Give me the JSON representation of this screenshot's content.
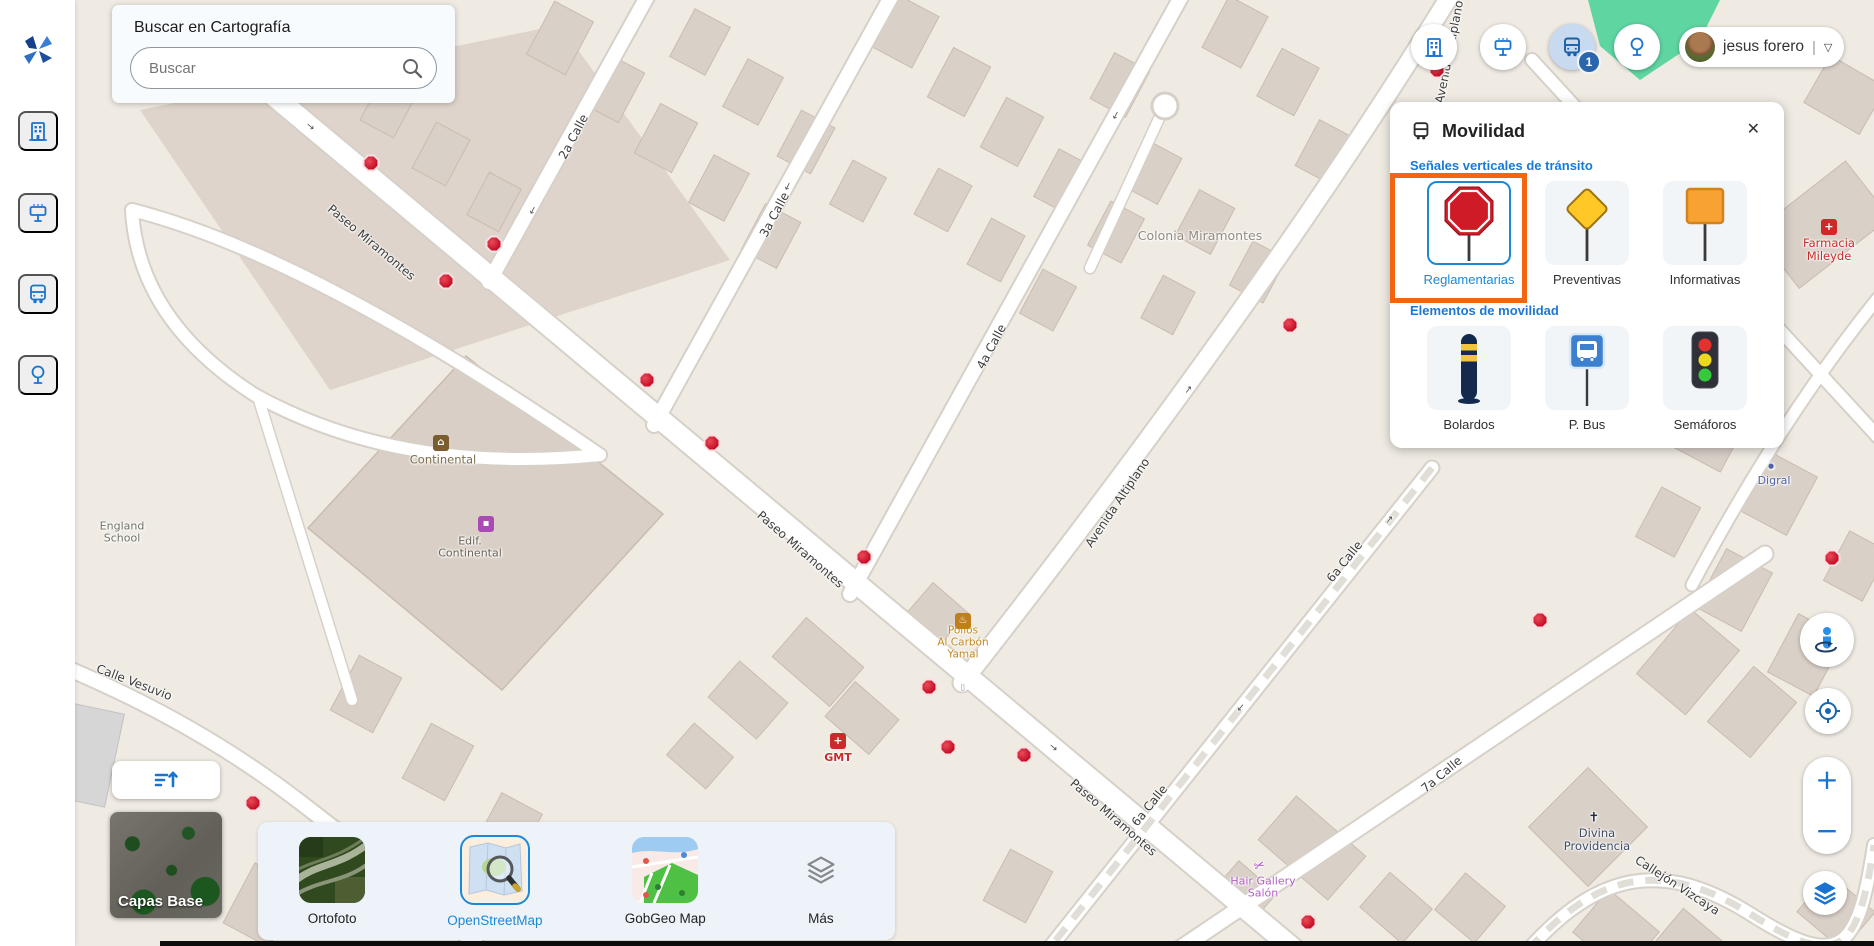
{
  "colors": {
    "accent": "#1a73d0",
    "selected_blue": "#1e88d2",
    "highlight_orange": "#f4650f",
    "marker_red": "#c30e26"
  },
  "search": {
    "title": "Buscar en Cartografía",
    "placeholder": "Buscar"
  },
  "sidebar": {
    "icons": [
      "app-logo",
      "buildings",
      "billboard",
      "bus",
      "tree"
    ]
  },
  "topbar": {
    "buttons": [
      "buildings",
      "billboard",
      "bus",
      "tree"
    ],
    "active_button": "bus",
    "badge": "1",
    "user": {
      "name": "jesus forero",
      "separator": "|",
      "caret": "▽"
    }
  },
  "movilidad": {
    "title": "Movilidad",
    "close": "✕",
    "sections": [
      {
        "title": "Señales verticales de tránsito",
        "items": [
          {
            "label": "Reglamentarias",
            "icon": "stop-sign",
            "selected": true,
            "highlighted": true
          },
          {
            "label": "Preventivas",
            "icon": "warning-diamond",
            "selected": false
          },
          {
            "label": "Informativas",
            "icon": "info-square",
            "selected": false
          }
        ]
      },
      {
        "title": "Elementos de movilidad",
        "items": [
          {
            "label": "Bolardos",
            "icon": "bollard",
            "selected": false
          },
          {
            "label": "P. Bus",
            "icon": "bus-stop-sign",
            "selected": false
          },
          {
            "label": "Semáforos",
            "icon": "traffic-light",
            "selected": false
          }
        ]
      }
    ]
  },
  "base": {
    "widget_label": "Capas Base",
    "options": [
      {
        "label": "Ortofoto",
        "selected": false
      },
      {
        "label": "OpenStreetMap",
        "selected": true
      },
      {
        "label": "GobGeo Map",
        "selected": false
      },
      {
        "label": "Más",
        "icon": "layers",
        "selected": false
      }
    ]
  },
  "controls": {
    "zoom_in": "+",
    "zoom_out": "−",
    "items": [
      "street-view",
      "locate",
      "zoom-in",
      "zoom-out",
      "layers"
    ]
  },
  "map": {
    "markers": [
      {
        "x": 371,
        "y": 163
      },
      {
        "x": 494,
        "y": 244
      },
      {
        "x": 446,
        "y": 281
      },
      {
        "x": 647,
        "y": 380
      },
      {
        "x": 712,
        "y": 443
      },
      {
        "x": 864,
        "y": 557
      },
      {
        "x": 929,
        "y": 687
      },
      {
        "x": 948,
        "y": 747
      },
      {
        "x": 1024,
        "y": 755
      },
      {
        "x": 1290,
        "y": 325
      },
      {
        "x": 1540,
        "y": 620
      },
      {
        "x": 1832,
        "y": 558
      },
      {
        "x": 253,
        "y": 803
      },
      {
        "x": 1308,
        "y": 922
      },
      {
        "x": 1437,
        "y": 70
      }
    ],
    "labels": [
      {
        "text": "2a Calle",
        "x": 574,
        "y": 137,
        "rot": -62
      },
      {
        "text": "3a Calle",
        "x": 775,
        "y": 215,
        "rot": -62
      },
      {
        "text": "4a Calle",
        "x": 992,
        "y": 347,
        "rot": -62
      },
      {
        "text": "6a Calle",
        "x": 1345,
        "y": 562,
        "rot": -51
      },
      {
        "text": "6a Calle",
        "x": 1150,
        "y": 806,
        "rot": -51
      },
      {
        "text": "7a Calle",
        "x": 1442,
        "y": 775,
        "rot": -40
      },
      {
        "text": "Paseo Miramontes",
        "x": 371,
        "y": 243,
        "rot": 40
      },
      {
        "text": "Paseo Miramontes",
        "x": 800,
        "y": 550,
        "rot": 41
      },
      {
        "text": "Paseo Miramontes",
        "x": 1113,
        "y": 818,
        "rot": 41
      },
      {
        "text": "Avenida Altiplano",
        "x": 1118,
        "y": 503,
        "rot": -56
      },
      {
        "text": "Avenida Altiplano",
        "x": 1450,
        "y": 52,
        "rot": -79
      },
      {
        "text": "Calle Vesuvio",
        "x": 134,
        "y": 683,
        "rot": 21
      },
      {
        "text": "Callejón Vizcaya",
        "x": 1677,
        "y": 886,
        "rot": 33
      },
      {
        "text": "Colonia Miramontes",
        "x": 1200,
        "y": 236,
        "rot": 0,
        "color": "#948b7e",
        "size": 12.5
      },
      {
        "text": "England\nSchool",
        "x": 122,
        "y": 533,
        "rot": 0,
        "color": "#6f7465",
        "size": 11
      },
      {
        "text": "Continental",
        "x": 443,
        "y": 460,
        "rot": 0,
        "color": "#7d6c4c",
        "size": 11.5
      },
      {
        "text": "Edif.\nContinental",
        "x": 470,
        "y": 548,
        "rot": 0,
        "color": "#6b6257",
        "size": 11
      },
      {
        "text": "Pollos\nAl Carbón\nYamal",
        "x": 963,
        "y": 643,
        "rot": 0,
        "color": "#c28a1f",
        "size": 10.5
      },
      {
        "text": "GMT",
        "x": 838,
        "y": 758,
        "rot": 0,
        "color": "#cc2a2a",
        "size": 11,
        "weight": "bold"
      },
      {
        "text": "Divina\nProvidencia",
        "x": 1597,
        "y": 840,
        "rot": 0,
        "color": "#3f4a66",
        "size": 11.5
      },
      {
        "text": "Hair Gallery\nSalón",
        "x": 1263,
        "y": 888,
        "rot": 0,
        "color": "#b35fc6",
        "size": 11
      },
      {
        "text": "Farmacia\nMileyde",
        "x": 1829,
        "y": 250,
        "rot": 0,
        "color": "#cc2a2a",
        "size": 11.5
      },
      {
        "text": "Digral",
        "x": 1774,
        "y": 481,
        "rot": 0,
        "color": "#5262a8",
        "size": 11
      },
      {
        "text": "⌂",
        "x": 441,
        "y": 443,
        "rot": 0,
        "bg": "#7a5c2e",
        "fg": "#fff",
        "size": 10,
        "name": "hotel-poi-icon"
      },
      {
        "text": "▪",
        "x": 486,
        "y": 524,
        "rot": 0,
        "bg": "#a94ab5",
        "fg": "#fff",
        "size": 10,
        "name": "shop-poi-icon"
      },
      {
        "text": "♨",
        "x": 963,
        "y": 621,
        "rot": 0,
        "bg": "#c07f1f",
        "fg": "#fff",
        "size": 10,
        "name": "restaurant-poi-icon"
      },
      {
        "text": "+",
        "x": 838,
        "y": 741,
        "rot": 0,
        "bg": "#cc2a2a",
        "fg": "#fff",
        "size": 11,
        "name": "pharmacy-poi-icon"
      },
      {
        "text": "+",
        "x": 1829,
        "y": 227,
        "rot": 0,
        "bg": "#cc2a2a",
        "fg": "#fff",
        "size": 11,
        "name": "pharmacy-poi-icon"
      },
      {
        "text": "✝",
        "x": 1594,
        "y": 819,
        "rot": 0,
        "color": "#23283a",
        "size": 13,
        "name": "church-poi-icon"
      },
      {
        "text": "✂",
        "x": 1260,
        "y": 867,
        "rot": -20,
        "color": "#a64bbf",
        "size": 13,
        "name": "hairdresser-poi-icon"
      },
      {
        "text": "●",
        "x": 1771,
        "y": 467,
        "rot": 0,
        "color": "#5262a8",
        "size": 7,
        "name": "poi-dot-icon"
      },
      {
        "text": "▯",
        "x": 963,
        "y": 688,
        "rot": 0,
        "color": "#8a8a8a",
        "size": 8,
        "name": "transit-poi-icon"
      },
      {
        "text": "→",
        "x": 532,
        "y": 210,
        "rot": 118,
        "color": "#555",
        "size": 10,
        "name": "oneway-arrow-icon"
      },
      {
        "text": "→",
        "x": 787,
        "y": 186,
        "rot": 118,
        "color": "#555",
        "size": 10,
        "name": "oneway-arrow-icon"
      },
      {
        "text": "→",
        "x": 1115,
        "y": 115,
        "rot": 118,
        "color": "#555",
        "size": 10,
        "name": "oneway-arrow-icon"
      },
      {
        "text": "→",
        "x": 1189,
        "y": 390,
        "rot": -54,
        "color": "#555",
        "size": 10,
        "name": "oneway-arrow-icon"
      },
      {
        "text": "→",
        "x": 1390,
        "y": 520,
        "rot": -51,
        "color": "#555",
        "size": 10,
        "name": "oneway-arrow-icon"
      },
      {
        "text": "→",
        "x": 1240,
        "y": 707,
        "rot": 130,
        "color": "#555",
        "size": 10,
        "name": "oneway-arrow-icon"
      },
      {
        "text": "→",
        "x": 310,
        "y": 127,
        "rot": 40,
        "color": "#555",
        "size": 10,
        "name": "oneway-arrow-icon"
      },
      {
        "text": "→",
        "x": 1053,
        "y": 748,
        "rot": 40,
        "color": "#555",
        "size": 10,
        "name": "oneway-arrow-icon"
      }
    ]
  }
}
